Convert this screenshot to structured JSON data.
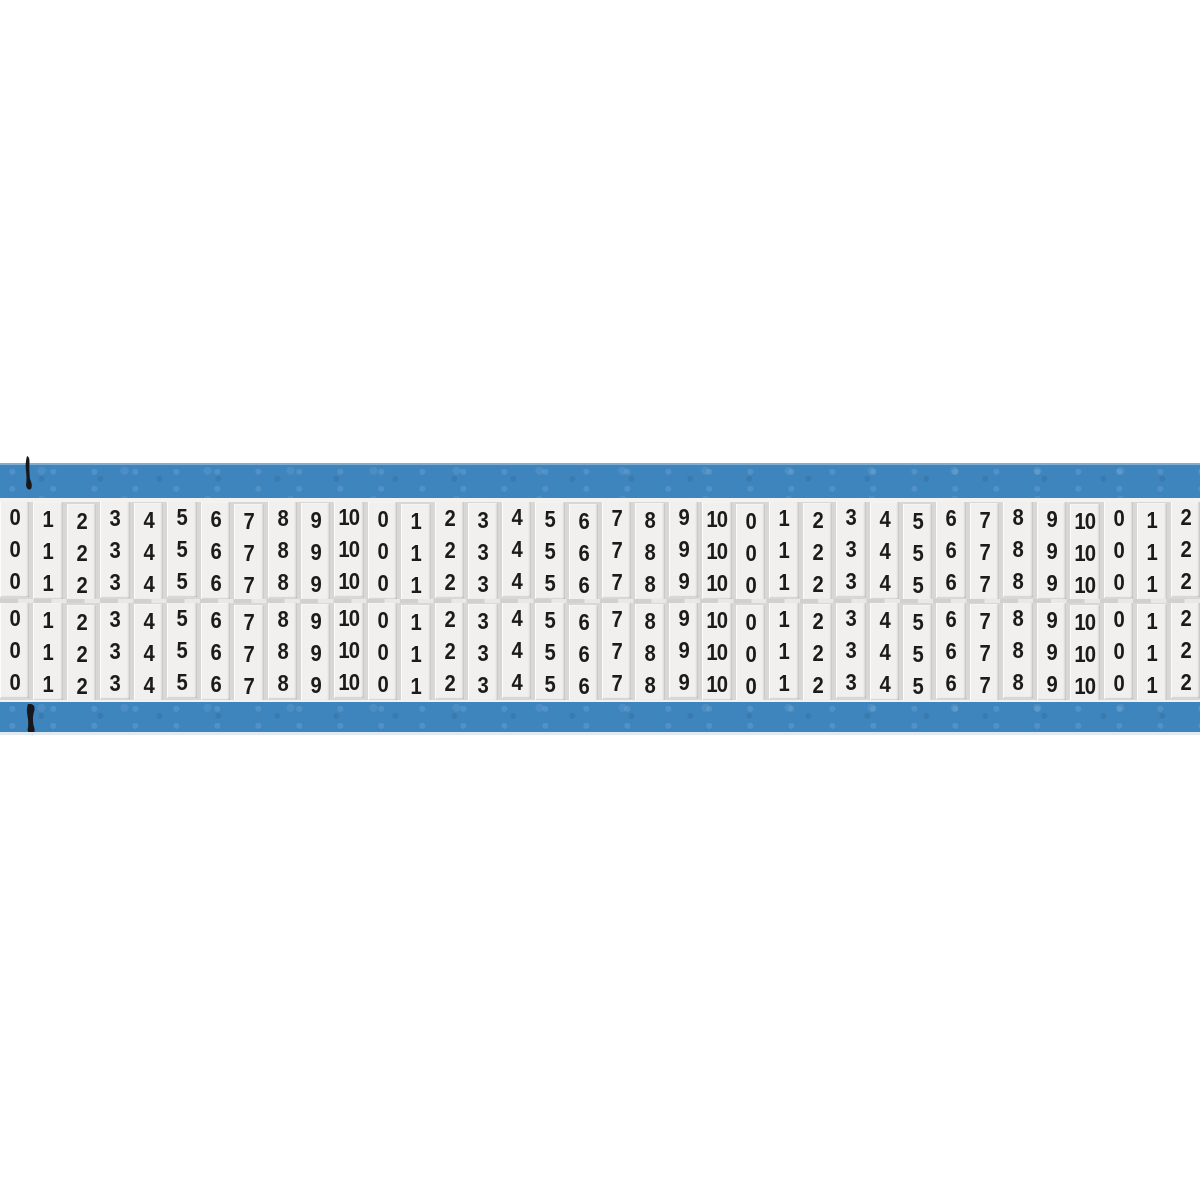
{
  "card": {
    "kind": "wire-marker-card",
    "column_values": [
      "0",
      "1",
      "2",
      "3",
      "4",
      "5",
      "6",
      "7",
      "8",
      "9",
      "10",
      "0",
      "1",
      "2",
      "3",
      "4",
      "5",
      "6",
      "7",
      "8",
      "9",
      "10",
      "0",
      "1",
      "2",
      "3",
      "4",
      "5",
      "6",
      "7",
      "8",
      "9",
      "10",
      "0",
      "1",
      "2"
    ],
    "repeats_per_column": 3,
    "sections": 2,
    "icons": {
      "top_mark": "registration-mark-icon",
      "bottom_mark": "registration-mark-icon"
    },
    "colors": {
      "card_blue": "#3e85be",
      "strip_white": "#f1f0ee",
      "gap_gray": "#d8d7d5",
      "digit_ink": "#1b1b1b",
      "page_background": "#ffffff",
      "shadow_line": "#e3eaef"
    }
  }
}
